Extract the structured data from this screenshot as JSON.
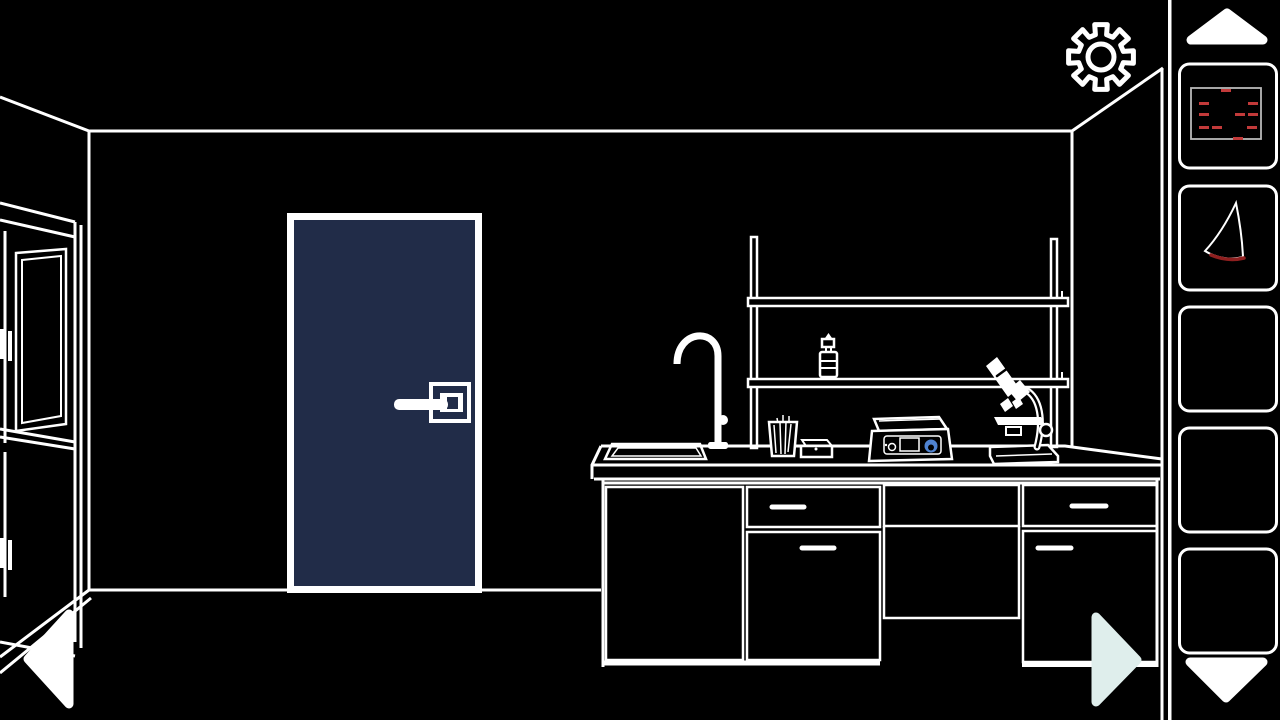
{
  "meta": {
    "app_type": "escape-room puzzle game",
    "scene_label": "Laboratory room with closed door, lab counter and shelves"
  },
  "colors": {
    "background": "#000000",
    "line": "#ffffff",
    "door_navy": "#212c48",
    "arrow_mint": "#dfeeec",
    "note_border": "#b9b9b9",
    "note_mark_red": "#c23a3a",
    "blade_red": "#8f1f1f",
    "knob_blue": "#4f83d1"
  },
  "header": {
    "settings": {
      "label": "Settings",
      "icon": "gear-icon"
    }
  },
  "navigation": {
    "left": {
      "label": "Go to previous view",
      "icon": "left-arrow-icon"
    },
    "right": {
      "label": "Go to next view",
      "icon": "right-arrow-icon"
    }
  },
  "inventory": {
    "scroll_up": {
      "label": "Scroll inventory up",
      "icon": "up-arrow-icon"
    },
    "scroll_down": {
      "label": "Scroll inventory down",
      "icon": "down-arrow-icon"
    },
    "slots": [
      {
        "index": 1,
        "item": "note-with-red-marks",
        "description": "light-bordered note with scattered red dash marks",
        "marks": [
          [
            30,
            1
          ],
          [
            8,
            14
          ],
          [
            57,
            14
          ],
          [
            8,
            25
          ],
          [
            44,
            25
          ],
          [
            57,
            25
          ],
          [
            8,
            38
          ],
          [
            21,
            38
          ],
          [
            56,
            38
          ],
          [
            42,
            49
          ]
        ]
      },
      {
        "index": 2,
        "item": "curved-blade",
        "description": "curved fin-shaped blade, red along bottom edge"
      },
      {
        "index": 3,
        "item": null
      },
      {
        "index": 4,
        "item": null
      },
      {
        "index": 5,
        "item": null
      }
    ]
  },
  "scene": {
    "objects": [
      {
        "name": "left-cabinet",
        "label": "Tall cabinet with panel doors"
      },
      {
        "name": "door",
        "label": "Closed navy door with lever handle"
      },
      {
        "name": "wall-shelves",
        "label": "Two wall shelves on posts"
      },
      {
        "name": "dropper-bottle",
        "label": "Dropper bottle on shelf"
      },
      {
        "name": "sink",
        "label": "Counter sink"
      },
      {
        "name": "faucet",
        "label": "Gooseneck faucet"
      },
      {
        "name": "brush-cup",
        "label": "Cup holding brushes"
      },
      {
        "name": "small-box",
        "label": "Small box on counter"
      },
      {
        "name": "hot-plate",
        "label": "Hot plate with blue knob"
      },
      {
        "name": "microscope",
        "label": "Microscope on counter"
      },
      {
        "name": "counter-cabinets",
        "label": "Lab counter with drawers and doors"
      }
    ]
  }
}
